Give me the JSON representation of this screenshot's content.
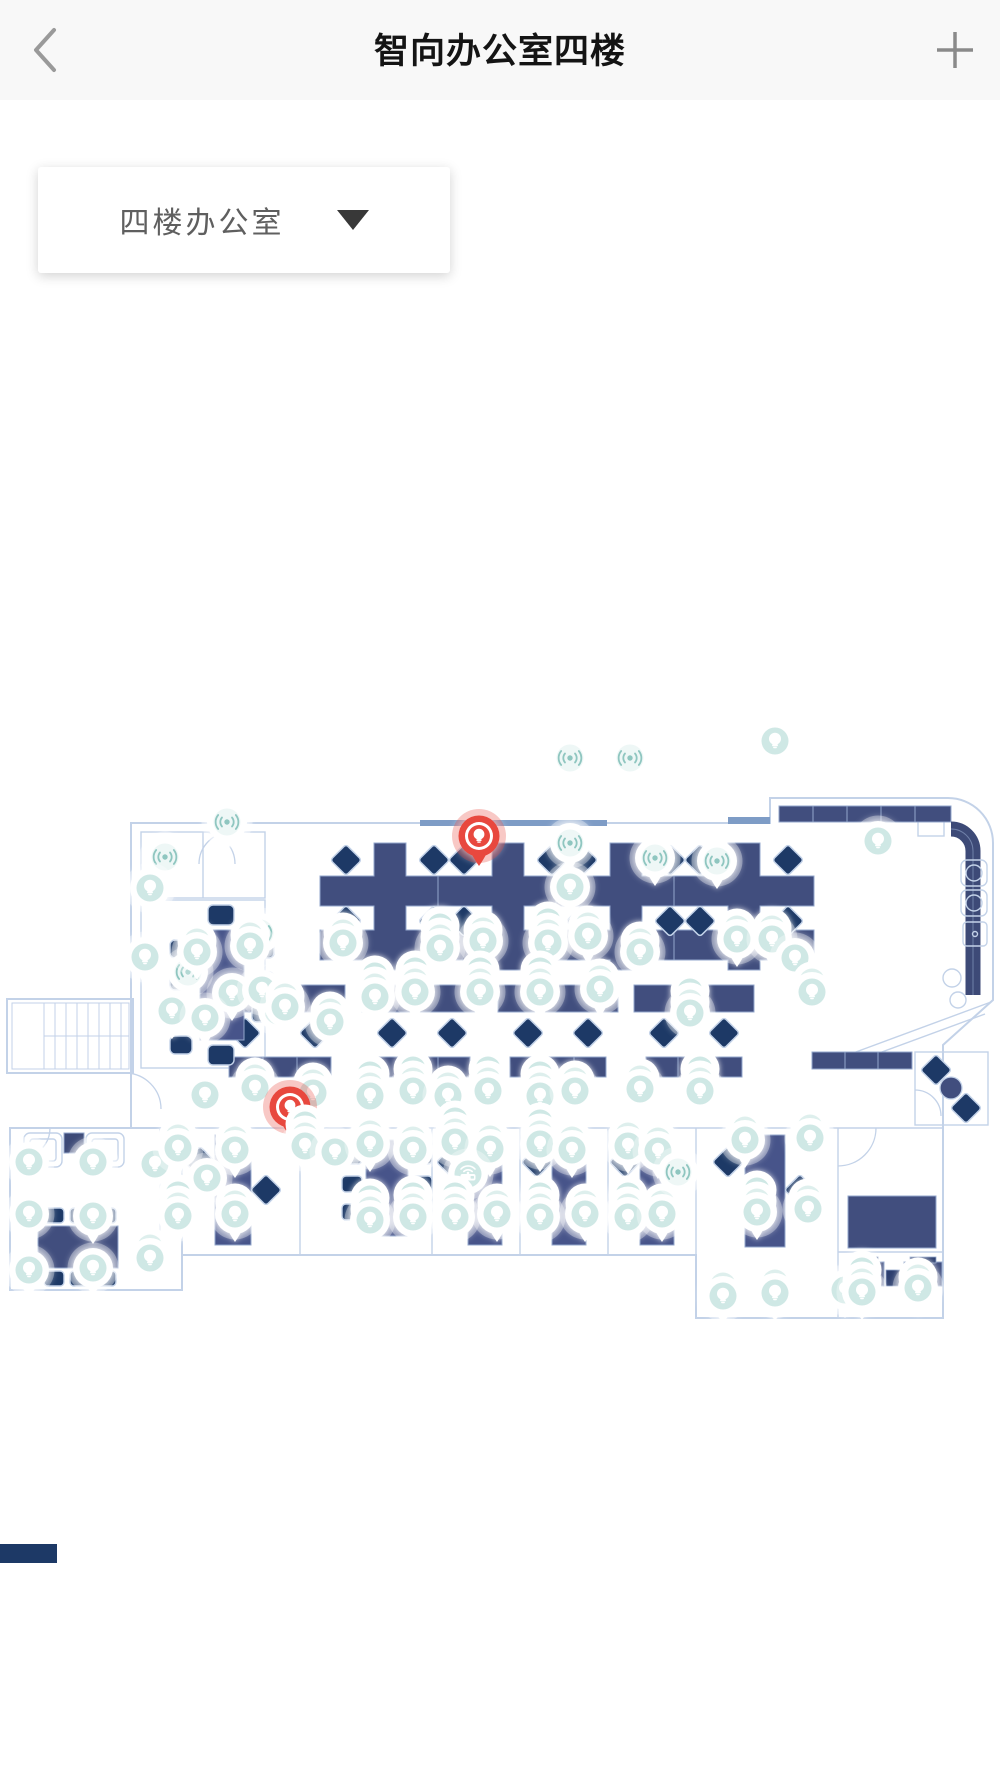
{
  "header": {
    "title": "智向办公室四楼",
    "back_icon": "chevron-left",
    "add_icon": "plus"
  },
  "floor_selector": {
    "value": "四楼办公室",
    "dropdown_icon": "caret-down"
  },
  "map": {
    "name": "office-floor-plan",
    "colors": {
      "floor": "#1d3966",
      "desk": "#414e7e",
      "desk_light": "#47548a",
      "wall_line": "#c3d2e8",
      "door_accent": "#7e9cc6",
      "pin_white": "#ffffff",
      "pin_teal_face": "#cfe8e5",
      "pin_glyph_teal": "#8fc6c0",
      "pin_alert_red": "#e8483e"
    },
    "pin_types": {
      "bulb": "smart-light-device",
      "signal": "sensor-device",
      "router": "gateway-device",
      "red": "alert-light-device"
    },
    "pins": [
      {
        "x": 570,
        "y": 758,
        "type": "signal",
        "count": 1
      },
      {
        "x": 630,
        "y": 758,
        "type": "signal",
        "count": 1
      },
      {
        "x": 775,
        "y": 741,
        "type": "bulb",
        "count": 1
      },
      {
        "x": 479,
        "y": 836,
        "type": "red",
        "count": 1
      },
      {
        "x": 570,
        "y": 843,
        "type": "signal",
        "count": 1
      },
      {
        "x": 655,
        "y": 858,
        "type": "signal",
        "count": 1
      },
      {
        "x": 717,
        "y": 861,
        "type": "signal",
        "count": 1
      },
      {
        "x": 570,
        "y": 887,
        "type": "bulb",
        "count": 1
      },
      {
        "x": 878,
        "y": 841,
        "type": "bulb",
        "count": 1
      },
      {
        "x": 227,
        "y": 822,
        "type": "signal",
        "count": 1
      },
      {
        "x": 165,
        "y": 857,
        "type": "signal",
        "count": 1
      },
      {
        "x": 150,
        "y": 888,
        "type": "bulb",
        "count": 1
      },
      {
        "x": 260,
        "y": 933,
        "type": "signal",
        "count": 1
      },
      {
        "x": 188,
        "y": 972,
        "type": "signal",
        "count": 1
      },
      {
        "x": 172,
        "y": 1011,
        "type": "bulb",
        "count": 1
      },
      {
        "x": 278,
        "y": 1011,
        "type": "bulb",
        "count": 1
      },
      {
        "x": 145,
        "y": 957,
        "type": "bulb",
        "count": 1
      },
      {
        "x": 197,
        "y": 952,
        "type": "bulb",
        "count": 2
      },
      {
        "x": 250,
        "y": 946,
        "type": "bulb",
        "count": 2
      },
      {
        "x": 343,
        "y": 943,
        "type": "bulb",
        "count": 2
      },
      {
        "x": 440,
        "y": 948,
        "type": "bulb",
        "count": 3
      },
      {
        "x": 483,
        "y": 941,
        "type": "bulb",
        "count": 2
      },
      {
        "x": 548,
        "y": 943,
        "type": "bulb",
        "count": 3
      },
      {
        "x": 588,
        "y": 936,
        "type": "bulb",
        "count": 2
      },
      {
        "x": 640,
        "y": 952,
        "type": "bulb",
        "count": 2
      },
      {
        "x": 737,
        "y": 939,
        "type": "bulb",
        "count": 2
      },
      {
        "x": 772,
        "y": 939,
        "type": "bulb",
        "count": 2
      },
      {
        "x": 795,
        "y": 958,
        "type": "bulb",
        "count": 1
      },
      {
        "x": 232,
        "y": 993,
        "type": "bulb",
        "count": 1
      },
      {
        "x": 262,
        "y": 990,
        "type": "bulb",
        "count": 1
      },
      {
        "x": 285,
        "y": 1007,
        "type": "bulb",
        "count": 2
      },
      {
        "x": 205,
        "y": 1018,
        "type": "bulb",
        "count": 1
      },
      {
        "x": 330,
        "y": 1022,
        "type": "bulb",
        "count": 2
      },
      {
        "x": 375,
        "y": 997,
        "type": "bulb",
        "count": 3
      },
      {
        "x": 415,
        "y": 992,
        "type": "bulb",
        "count": 3
      },
      {
        "x": 480,
        "y": 992,
        "type": "bulb",
        "count": 3
      },
      {
        "x": 540,
        "y": 992,
        "type": "bulb",
        "count": 3
      },
      {
        "x": 600,
        "y": 989,
        "type": "bulb",
        "count": 2
      },
      {
        "x": 690,
        "y": 1013,
        "type": "bulb",
        "count": 3
      },
      {
        "x": 812,
        "y": 992,
        "type": "bulb",
        "count": 2
      },
      {
        "x": 205,
        "y": 1095,
        "type": "bulb",
        "count": 1
      },
      {
        "x": 255,
        "y": 1088,
        "type": "bulb",
        "count": 2
      },
      {
        "x": 313,
        "y": 1093,
        "type": "bulb",
        "count": 2
      },
      {
        "x": 290,
        "y": 1107,
        "type": "red",
        "count": 1
      },
      {
        "x": 370,
        "y": 1096,
        "type": "bulb",
        "count": 3
      },
      {
        "x": 413,
        "y": 1091,
        "type": "bulb",
        "count": 3
      },
      {
        "x": 448,
        "y": 1096,
        "type": "bulb",
        "count": 2
      },
      {
        "x": 488,
        "y": 1091,
        "type": "bulb",
        "count": 3
      },
      {
        "x": 540,
        "y": 1096,
        "type": "bulb",
        "count": 3
      },
      {
        "x": 575,
        "y": 1091,
        "type": "bulb",
        "count": 2
      },
      {
        "x": 640,
        "y": 1089,
        "type": "bulb",
        "count": 2
      },
      {
        "x": 700,
        "y": 1091,
        "type": "bulb",
        "count": 3
      },
      {
        "x": 29,
        "y": 1162,
        "type": "bulb",
        "count": 1
      },
      {
        "x": 93,
        "y": 1162,
        "type": "bulb",
        "count": 1
      },
      {
        "x": 155,
        "y": 1164,
        "type": "bulb",
        "count": 1
      },
      {
        "x": 29,
        "y": 1214,
        "type": "bulb",
        "count": 1
      },
      {
        "x": 93,
        "y": 1216,
        "type": "bulb",
        "count": 1
      },
      {
        "x": 29,
        "y": 1270,
        "type": "bulb",
        "count": 1
      },
      {
        "x": 93,
        "y": 1268,
        "type": "bulb",
        "count": 1
      },
      {
        "x": 150,
        "y": 1258,
        "type": "bulb",
        "count": 2
      },
      {
        "x": 178,
        "y": 1148,
        "type": "bulb",
        "count": 2
      },
      {
        "x": 235,
        "y": 1150,
        "type": "bulb",
        "count": 2
      },
      {
        "x": 207,
        "y": 1178,
        "type": "bulb",
        "count": 1
      },
      {
        "x": 178,
        "y": 1216,
        "type": "bulb",
        "count": 3
      },
      {
        "x": 235,
        "y": 1214,
        "type": "bulb",
        "count": 2
      },
      {
        "x": 305,
        "y": 1146,
        "type": "bulb",
        "count": 3
      },
      {
        "x": 335,
        "y": 1152,
        "type": "bulb",
        "count": 1
      },
      {
        "x": 370,
        "y": 1144,
        "type": "bulb",
        "count": 2
      },
      {
        "x": 413,
        "y": 1150,
        "type": "bulb",
        "count": 2
      },
      {
        "x": 370,
        "y": 1220,
        "type": "bulb",
        "count": 3
      },
      {
        "x": 413,
        "y": 1217,
        "type": "bulb",
        "count": 3
      },
      {
        "x": 455,
        "y": 1142,
        "type": "bulb",
        "count": 3
      },
      {
        "x": 490,
        "y": 1149,
        "type": "bulb",
        "count": 2
      },
      {
        "x": 468,
        "y": 1174,
        "type": "router",
        "count": 1
      },
      {
        "x": 455,
        "y": 1217,
        "type": "bulb",
        "count": 3
      },
      {
        "x": 497,
        "y": 1214,
        "type": "bulb",
        "count": 2
      },
      {
        "x": 540,
        "y": 1144,
        "type": "bulb",
        "count": 3
      },
      {
        "x": 572,
        "y": 1150,
        "type": "bulb",
        "count": 2
      },
      {
        "x": 540,
        "y": 1217,
        "type": "bulb",
        "count": 3
      },
      {
        "x": 585,
        "y": 1214,
        "type": "bulb",
        "count": 2
      },
      {
        "x": 628,
        "y": 1146,
        "type": "bulb",
        "count": 2
      },
      {
        "x": 658,
        "y": 1151,
        "type": "bulb",
        "count": 2
      },
      {
        "x": 628,
        "y": 1217,
        "type": "bulb",
        "count": 3
      },
      {
        "x": 662,
        "y": 1214,
        "type": "bulb",
        "count": 2
      },
      {
        "x": 678,
        "y": 1172,
        "type": "signal",
        "count": 1
      },
      {
        "x": 745,
        "y": 1140,
        "type": "bulb",
        "count": 2
      },
      {
        "x": 810,
        "y": 1138,
        "type": "bulb",
        "count": 2
      },
      {
        "x": 757,
        "y": 1212,
        "type": "bulb",
        "count": 3
      },
      {
        "x": 808,
        "y": 1209,
        "type": "bulb",
        "count": 2
      },
      {
        "x": 723,
        "y": 1296,
        "type": "bulb",
        "count": 2
      },
      {
        "x": 775,
        "y": 1293,
        "type": "bulb",
        "count": 2
      },
      {
        "x": 845,
        "y": 1290,
        "type": "bulb",
        "count": 1
      },
      {
        "x": 862,
        "y": 1292,
        "type": "bulb",
        "count": 3
      },
      {
        "x": 918,
        "y": 1288,
        "type": "bulb",
        "count": 2
      }
    ]
  }
}
